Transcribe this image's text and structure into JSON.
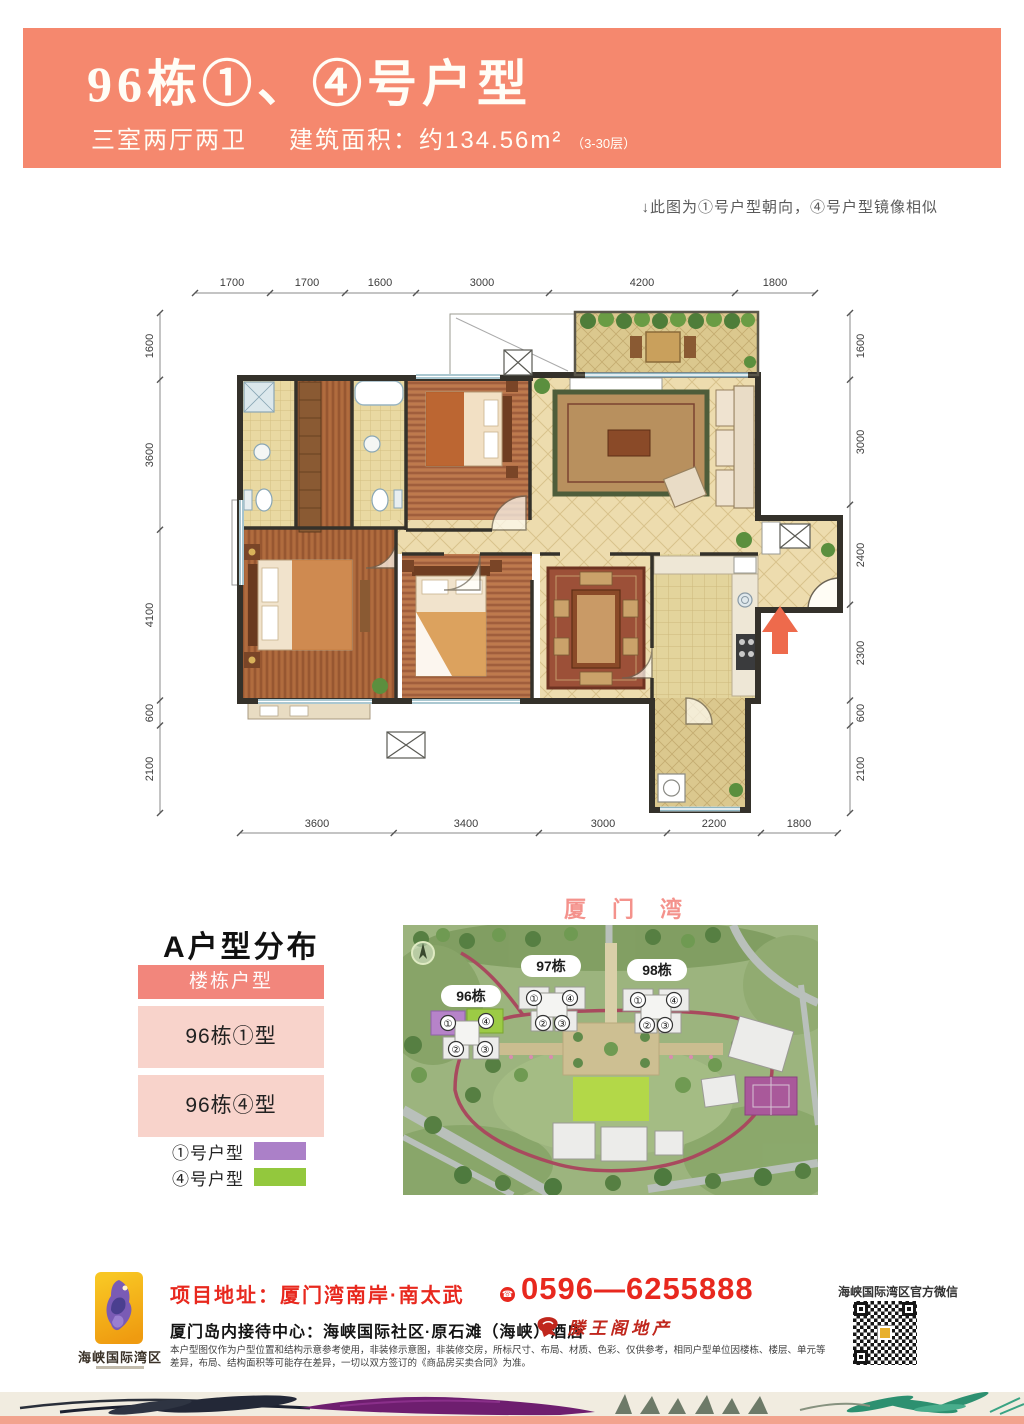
{
  "header": {
    "title": "96栋①、④号户型",
    "subtitle_rooms": "三室两厅两卫",
    "subtitle_area": "建筑面积：约134.56m²",
    "subtitle_floors": "（3-30层）"
  },
  "note": "↓此图为①号户型朝向，④号户型镜像相似",
  "floorplan": {
    "dims_top": [
      "1700",
      "1700",
      "1600",
      "3000",
      "4200",
      "1800"
    ],
    "dims_left": [
      "1600",
      "3600",
      "4100",
      "600",
      "2100"
    ],
    "dims_right": [
      "1600",
      "3000",
      "2400",
      "2300",
      "600",
      "2100"
    ],
    "dims_bottom": [
      "3600",
      "3400",
      "3000",
      "2200",
      "1800"
    ]
  },
  "distribution": {
    "heading": "A户型分布",
    "table_header": "楼栋户型",
    "rows": [
      "96栋①型",
      "96栋④型"
    ],
    "legend": [
      {
        "label": "①号户型",
        "color": "#ab80c8"
      },
      {
        "label": "④号户型",
        "color": "#93c83d"
      }
    ]
  },
  "sitemap": {
    "title": "厦门湾",
    "buildings": [
      "96栋",
      "97栋",
      "98栋"
    ],
    "units": [
      "①",
      "④",
      "②",
      "③"
    ]
  },
  "footer": {
    "brand": "海峡国际湾区",
    "address": "项目地址：厦门湾南岸·南太武",
    "phone": "0596—6255888",
    "phone_icon": "☎",
    "reception": "厦门岛内接待中心：海峡国际社区·原石滩（海峡）酒店",
    "agency": "滕王阁地产",
    "wechat": "海峡国际湾区官方微信",
    "disclaimer": "本户型图仅作为户型位置和结构示意参考使用，非装修示意图，非装修交房，所标尺寸、布局、材质、色彩、仅供参考，相同户型单位因楼栋、楼层、单元等差异，布局、结构面积等可能存在差异，一切以双方签订的《商品房买卖合同》为准。"
  }
}
